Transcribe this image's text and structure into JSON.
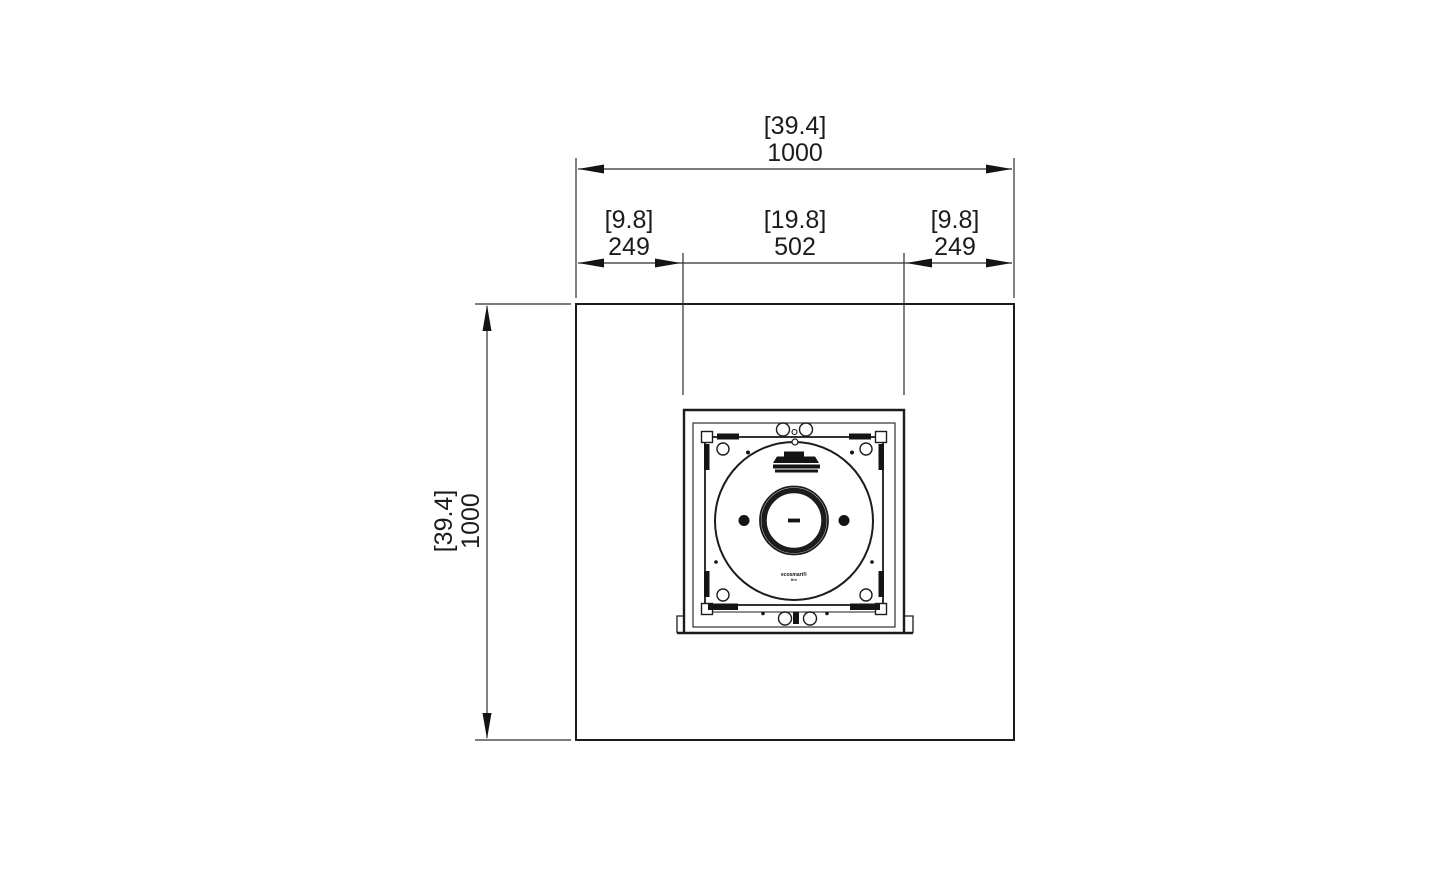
{
  "page": {
    "background": "#ffffff"
  },
  "style": {
    "line_color": "#1c1c1c",
    "dim_line_color": "#2e2e2e",
    "text_color": "#1c1c1c"
  },
  "dimensions": {
    "overall_width": {
      "inches": "[39.4]",
      "mm": "1000"
    },
    "overall_height": {
      "inches": "[39.4]",
      "mm": "1000"
    },
    "left_inset": {
      "inches": "[9.8]",
      "mm": "249"
    },
    "burner_opening": {
      "inches": "[19.8]",
      "mm": "502"
    },
    "right_inset": {
      "inches": "[9.8]",
      "mm": "249"
    }
  },
  "burner": {
    "brand_line1": "ecosmart®",
    "brand_line2": "fire"
  }
}
